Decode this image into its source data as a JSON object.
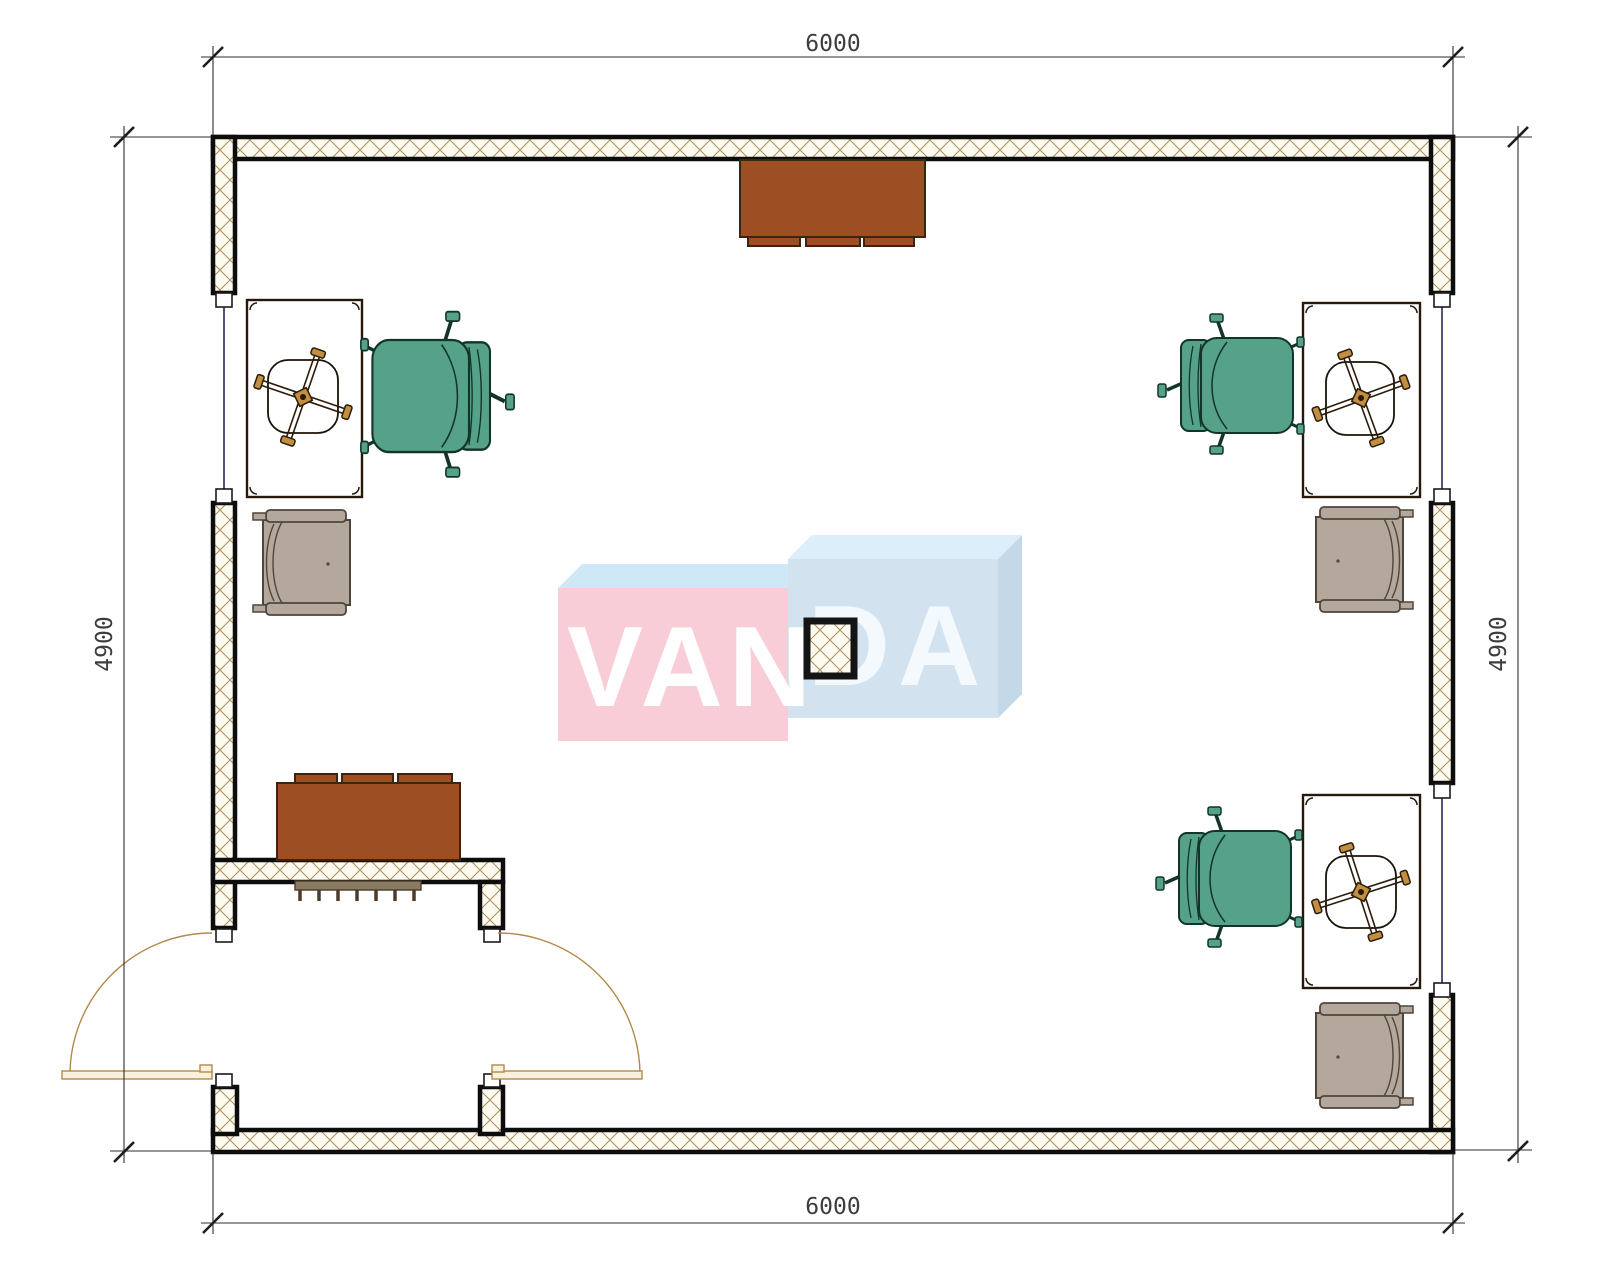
{
  "drawing": {
    "kind": "office-floor-plan",
    "dimensions": {
      "top": "6000",
      "bottom": "6000",
      "left": "4900",
      "right": "4900"
    },
    "watermark": {
      "left": "VAN",
      "right": "DA"
    },
    "colors": {
      "desk": "#c28f3e",
      "chair": "#55a189",
      "armchair": "#b3a89b",
      "cabinet": "#9d4e22",
      "radiator": "#8a7a62",
      "hatch_line": "#a8905e",
      "hatch_bg": "#fdfaf0",
      "wm_left_face": "#f8cdd8",
      "wm_left_top": "#cfe8f6",
      "wm_right_face": "#d3e2ef",
      "wm_right_top": "#dceefa",
      "wm_right_side": "#c5d8e8",
      "wm_text_left": "#ffffff",
      "wm_text_right": "#f3f9fd"
    }
  }
}
